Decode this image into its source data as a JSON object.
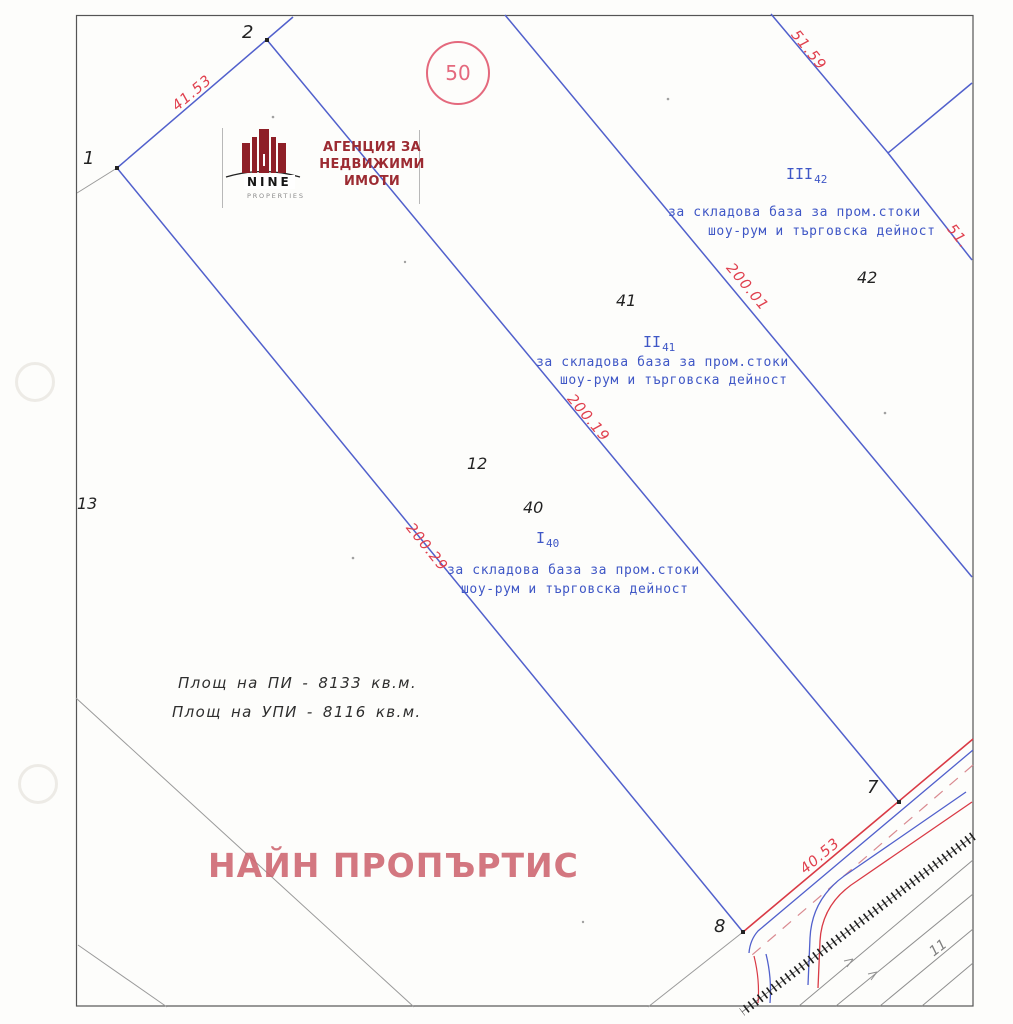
{
  "logo": {
    "brand": "NINE",
    "brand_sub": "PROPERTIES",
    "agency_line1": "АГЕНЦИЯ ЗА",
    "agency_line2": "НЕДВИЖИМИ ИМОТИ"
  },
  "stamp": {
    "sheet_number": "50"
  },
  "survey_points": {
    "p1": "1",
    "p2": "2",
    "p7": "7",
    "p8": "8"
  },
  "cadastral_numbers": {
    "n11": "11",
    "n12": "12",
    "n13": "13",
    "n40": "40",
    "n41": "41",
    "n42": "42"
  },
  "regulated_plots": {
    "plot40": {
      "roman": "I",
      "sub": "40"
    },
    "plot41": {
      "roman": "II",
      "sub": "41"
    },
    "plot42": {
      "roman": "III",
      "sub": "42"
    }
  },
  "designation": {
    "line1": "за складова база за пром.стоки",
    "line2": "шоу-рум и търговска дейност"
  },
  "dimensions": {
    "d_41_53": "41.53",
    "d_51_59": "51.59",
    "d_51": "51.",
    "d_200_01": "200.01",
    "d_200_19": "200.19",
    "d_200_29": "200.29",
    "d_40_53": "40.53"
  },
  "areas": {
    "pi": "Площ на ПИ - 8133 кв.м.",
    "upi": "Площ на УПИ - 8116 кв.м."
  },
  "watermark": "НАЙН ПРОПЪРТИС",
  "colors": {
    "boundary_blue": "#5160cc",
    "annotation_blue": "#3f57c6",
    "dimension_red": "#e0404e",
    "stamp_pink": "#e4697d",
    "watermark_pink": "#cd646e",
    "logo_maroon": "#8e1f27",
    "line_gray": "#8f8f8f"
  }
}
